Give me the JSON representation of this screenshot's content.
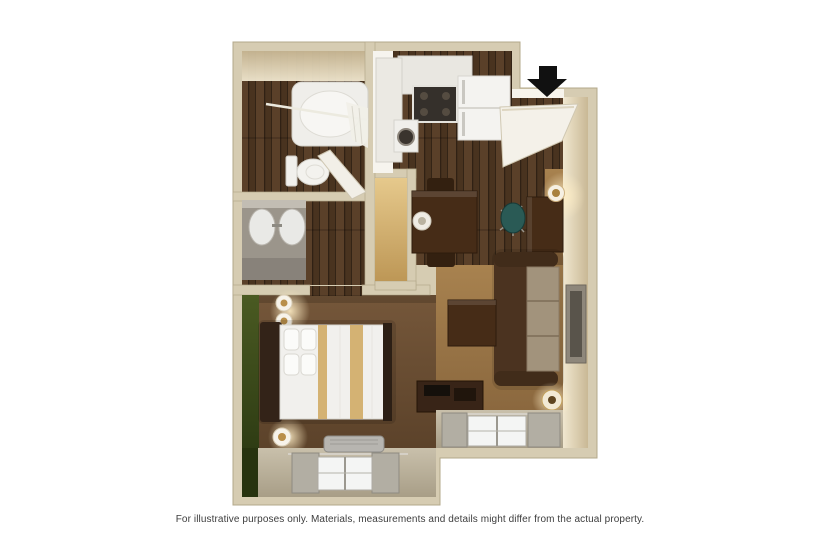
{
  "caption": "For illustrative purposes only.  Materials, measurements and details might differ from the actual property.",
  "plan": {
    "type": "3d-floor-plan",
    "rooms": [
      "bathroom",
      "vanity-area",
      "kitchen",
      "entry",
      "dining-area",
      "work-area",
      "living-room",
      "bedroom"
    ],
    "entry_marker": "black-down-arrow"
  },
  "colors": {
    "page_bg": "#ffffff",
    "wall": "#d6ccb2",
    "wall_edge": "#b3a88b",
    "wall_face_light": "#f0e7cf",
    "wall_face_dark": "#c9b895",
    "wood_dark": "#49331f",
    "wood_mid": "#6b4e33",
    "carpet_living": "#a8824f",
    "carpet_living_dark": "#83613a",
    "carpet_bedroom": "#75573a",
    "carpet_bedroom_dark": "#543c25",
    "green_wall": "#4a5a22",
    "green_wall_dark": "#26330f",
    "fixture_white": "#f2f1ed",
    "counter_gray": "#9b958b",
    "sofa_brown": "#4b3320",
    "cushion_tan": "#a2937c",
    "furniture_brown": "#462c17",
    "bed_stripe_tan": "#d4b273",
    "headboard_brown": "#332318",
    "chair_teal": "#2a5a55",
    "tv_gray": "#8e877b",
    "curtain_gray": "#b2aea3",
    "window_band_light": "#c9c0ab",
    "window_band_dark": "#a89e87",
    "closet_tan_light": "#e6c98c",
    "closet_tan_dark": "#bd9756",
    "arrow_black": "#111111",
    "caption_text": "#3d3d3d"
  }
}
